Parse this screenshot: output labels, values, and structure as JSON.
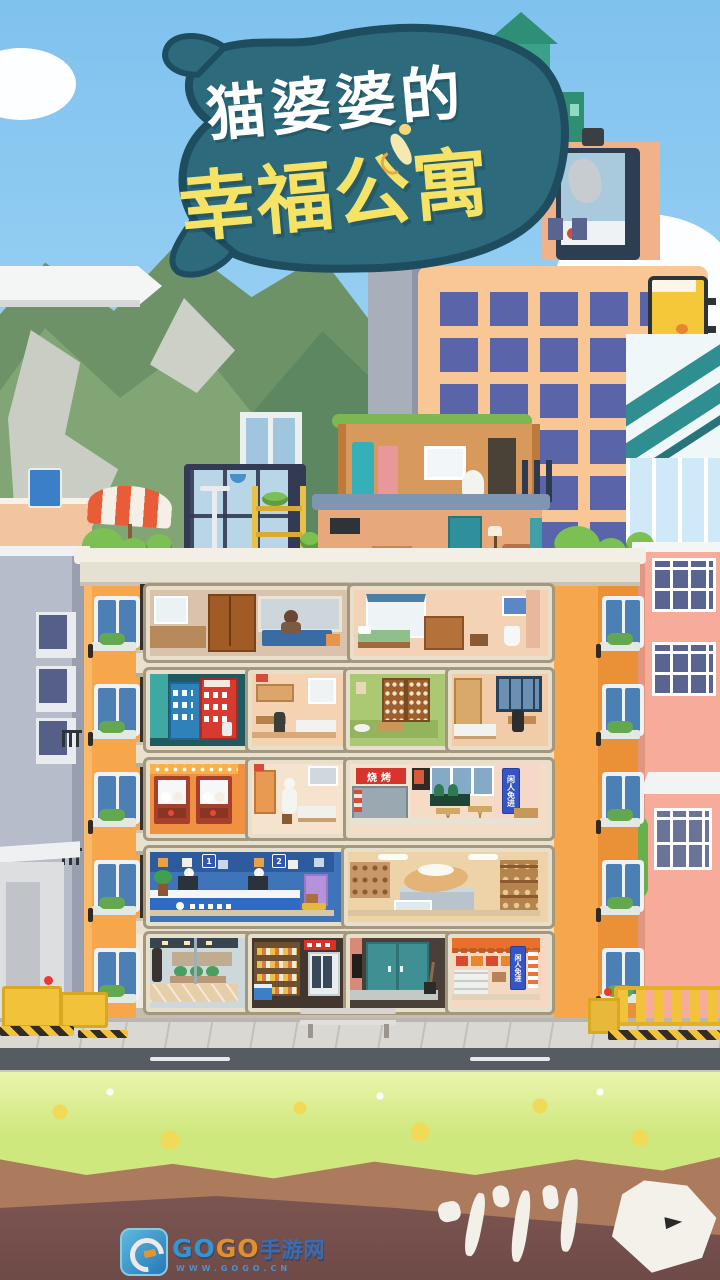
{
  "title": {
    "line1": "猫婆婆的",
    "line2": "幸福公寓"
  },
  "signs": {
    "bbq": "烧烤",
    "no_entry_f3": "闲人免进",
    "no_entry_f1": "闲人免进",
    "teller_1": "1",
    "teller_2": "2"
  },
  "watermark": {
    "go1": "GO",
    "go2": "GO",
    "suffix": "手游网",
    "url": "WWW.GOGO.CN"
  },
  "palette": {
    "sky": "#9ed3f5",
    "logo_blob": "#2d6a7c",
    "logo_outline": "#1d4d5f",
    "title_white": "#ffffff",
    "title_yellow": "#f6e366",
    "building_orange": "#f6a74b",
    "roof_slab": "#f3efe6",
    "interior_dark": "#35302a",
    "skyscraper": "#f8c795",
    "skyscraper_window": "#5a64a8",
    "neighbor_left": "#b6bcc9",
    "neighbor_right": "#f7ab9b",
    "road": "#575c62",
    "sidewalk": "#dad8d3",
    "grass": "#cfe87e",
    "dirt_light": "#ac7a5c",
    "dirt_dark": "#7e5752",
    "banner_blue": "#3555c2",
    "banner_red": "#d6352b"
  }
}
